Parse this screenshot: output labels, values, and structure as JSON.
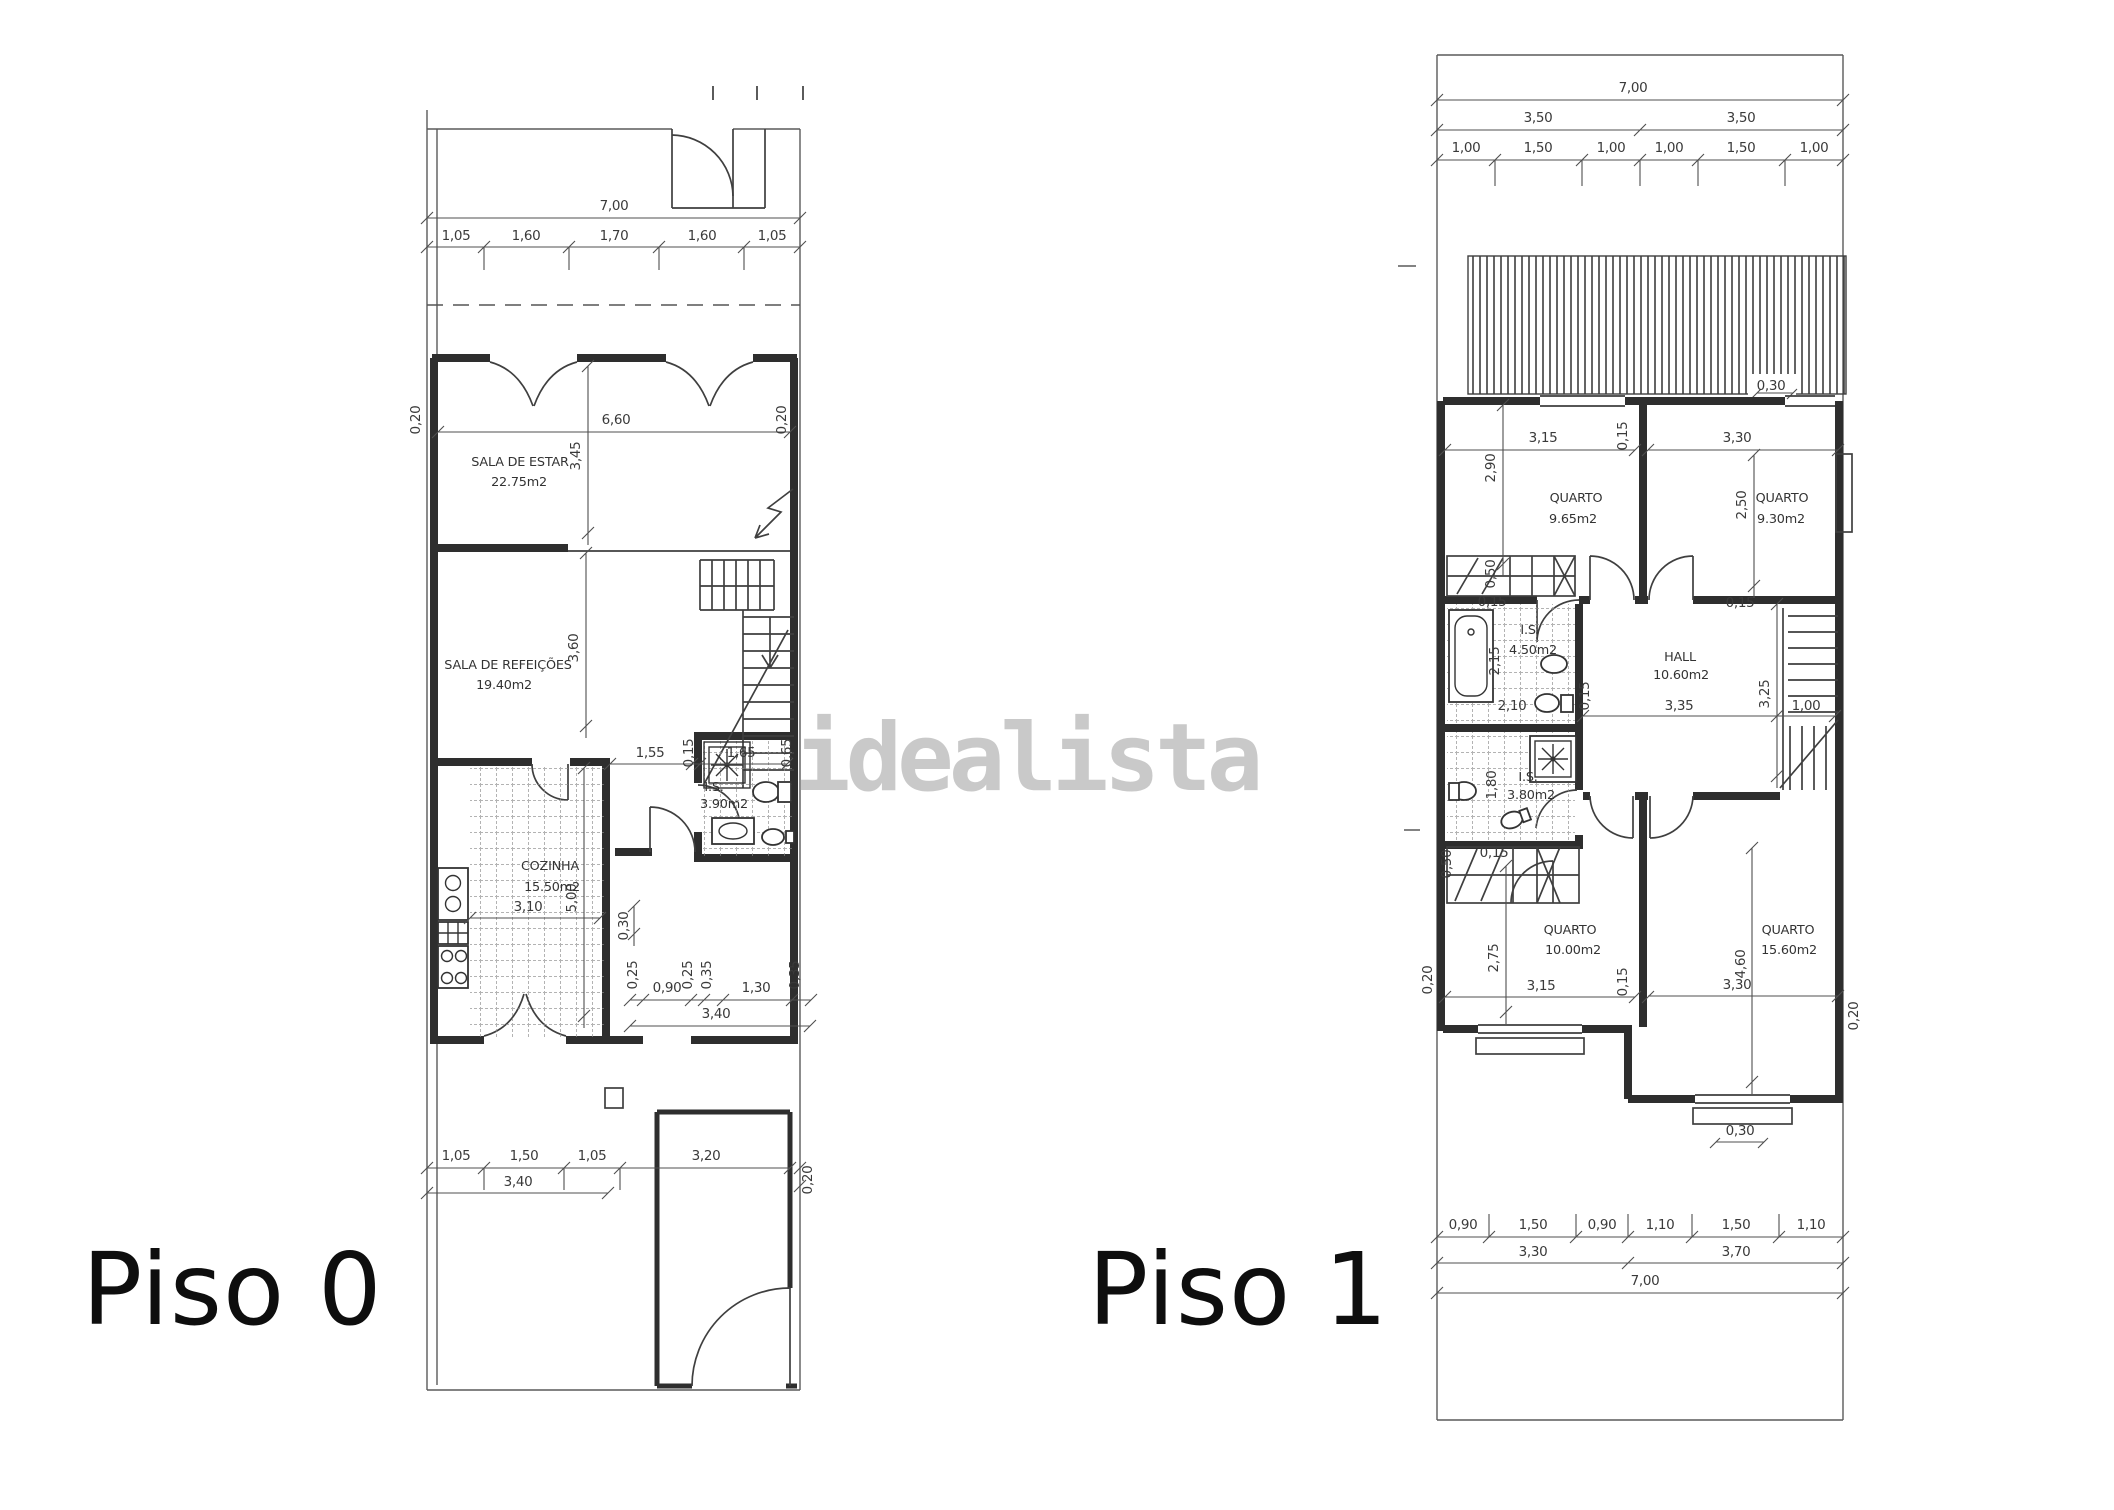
{
  "watermark": {
    "text": "idealista"
  },
  "p0": {
    "label": "Piso 0",
    "rooms": [
      {
        "n": "SALA DE ESTAR",
        "a": "22.75m2"
      },
      {
        "n": "SALA DE REFEIÇÕES",
        "a": "19.40m2"
      },
      {
        "n": "COZINHA",
        "a": "15.50m2"
      },
      {
        "n": "I.S.",
        "a": "3.90m2"
      }
    ],
    "d": [
      "7,00",
      "1,05",
      "1,60",
      "1,70",
      "1,60",
      "1,05",
      "0,20",
      "6,60",
      "0,20",
      "3,45",
      "3,60",
      "1,55",
      "0,15",
      "1,65",
      "0,65",
      "3,10",
      "5,00",
      "0,30",
      "0,25",
      "0,90",
      "0,25",
      "0,35",
      "1,30",
      "0,35",
      "3,40",
      "1,05",
      "1,50",
      "1,05",
      "3,20",
      "3,40",
      "0,20"
    ]
  },
  "p1": {
    "label": "Piso 1",
    "rooms": [
      {
        "n": "QUARTO",
        "a": "9.65m2"
      },
      {
        "n": "QUARTO",
        "a": "9.30m2"
      },
      {
        "n": "I.S.",
        "a": "4.50m2"
      },
      {
        "n": "HALL",
        "a": "10.60m2"
      },
      {
        "n": "I.S.",
        "a": "3.80m2"
      },
      {
        "n": "QUARTO",
        "a": "10.00m2"
      },
      {
        "n": "QUARTO",
        "a": "15.60m2"
      }
    ],
    "d": [
      "7,00",
      "3,50",
      "3,50",
      "1,00",
      "1,50",
      "1,00",
      "1,00",
      "1,50",
      "1,00",
      "3,15",
      "0,15",
      "3,30",
      "2,90",
      "2,50",
      "0,30",
      "0,50",
      "0,15",
      "2,15",
      "2,10",
      "0,15",
      "0,15",
      "3,35",
      "3,25",
      "1,00",
      "1,80",
      "0,15",
      "0,50",
      "2,75",
      "3,15",
      "0,15",
      "0,20",
      "3,30",
      "4,60",
      "0,20",
      "0,30",
      "0,90",
      "1,50",
      "0,90",
      "1,10",
      "1,50",
      "1,10",
      "3,30",
      "3,70",
      "7,00"
    ]
  }
}
